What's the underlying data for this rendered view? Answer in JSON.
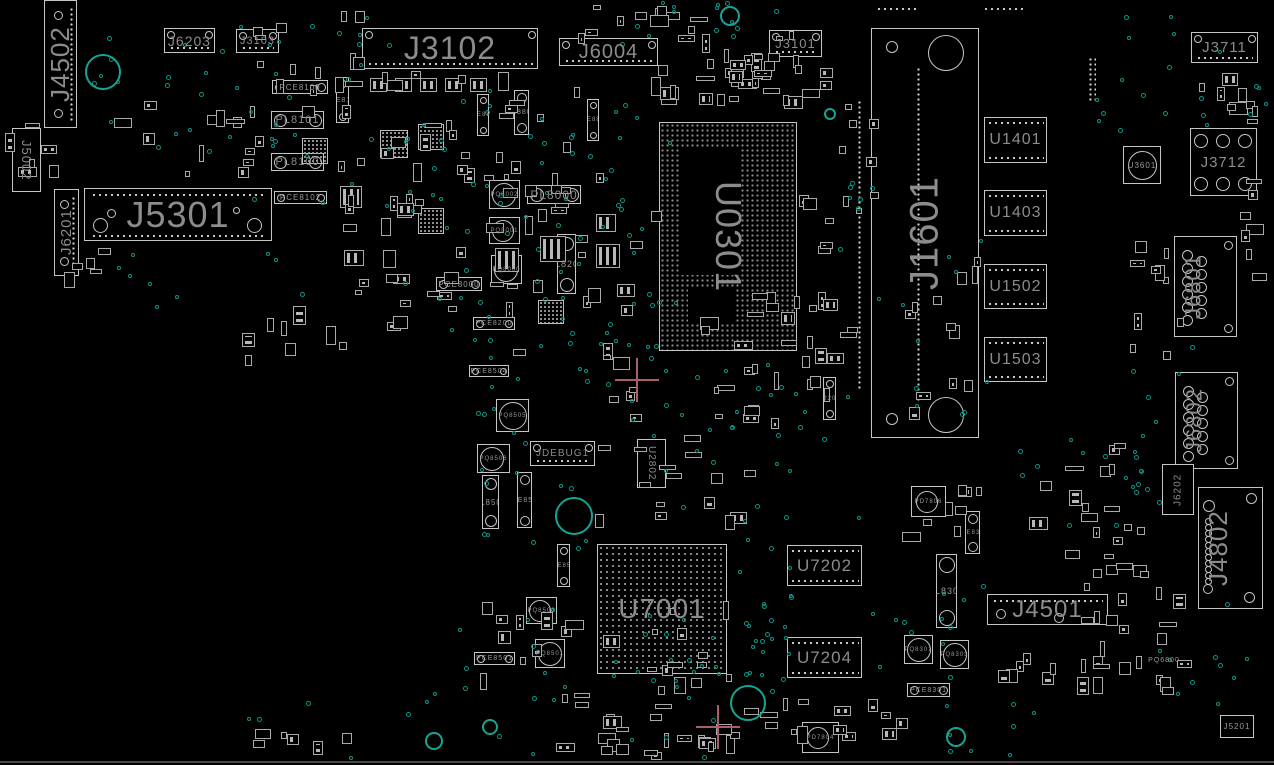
{
  "board": {
    "width": 1274,
    "height": 765,
    "colors": {
      "background": "#000000",
      "outline": "#c6c6c6",
      "label": "#8c8c8c",
      "via_teal": "#0e9488",
      "ring_teal": "#14a594",
      "fiducial_pink": "#a8606e"
    },
    "components": [
      {
        "r": "J4502",
        "k": "edgev",
        "x": 44,
        "y": 0,
        "w": 33,
        "h": 128,
        "f": 26,
        "o": "v",
        "d": "u"
      },
      {
        "r": "J5002",
        "k": "box",
        "x": 12,
        "y": 128,
        "w": 29,
        "h": 64,
        "f": 13,
        "o": "v",
        "d": "d"
      },
      {
        "r": "J6201",
        "k": "edgev",
        "x": 54,
        "y": 189,
        "w": 25,
        "h": 87,
        "f": 15,
        "o": "v",
        "d": "u"
      },
      {
        "r": "J5301",
        "k": "bigconn",
        "x": 84,
        "y": 188,
        "w": 188,
        "h": 53,
        "f": 36,
        "o": "h"
      },
      {
        "r": "J6203",
        "k": "box",
        "x": 164,
        "y": 28,
        "w": 51,
        "h": 25,
        "f": 14,
        "o": "h",
        "dots": "b",
        "corners": [
          "tl",
          "tr"
        ]
      },
      {
        "r": "J3103",
        "k": "box",
        "x": 236,
        "y": 29,
        "w": 43,
        "h": 24,
        "f": 11,
        "o": "h",
        "dots": "b",
        "corners": [
          "tl",
          "tr"
        ]
      },
      {
        "r": "J3102",
        "k": "box",
        "x": 362,
        "y": 28,
        "w": 176,
        "h": 41,
        "f": 32,
        "o": "h",
        "dots": "b",
        "corners": [
          "tl",
          "tr"
        ]
      },
      {
        "r": "J6004",
        "k": "box",
        "x": 559,
        "y": 38,
        "w": 99,
        "h": 28,
        "f": 20,
        "o": "h",
        "dots": "b",
        "corners": [
          "tl",
          "tr"
        ]
      },
      {
        "r": "J3101",
        "k": "box",
        "x": 769,
        "y": 30,
        "w": 53,
        "h": 27,
        "f": 13,
        "o": "h",
        "dots": "b",
        "corners": [
          "tl",
          "tr"
        ]
      },
      {
        "r": "J3711",
        "k": "box",
        "x": 1191,
        "y": 32,
        "w": 67,
        "h": 31,
        "f": 15,
        "o": "h",
        "dots": "b",
        "corners": [
          "tl",
          "tr"
        ]
      },
      {
        "r": "U0301",
        "k": "bga",
        "x": 659,
        "y": 122,
        "w": 138,
        "h": 229,
        "f": 36,
        "o": "v",
        "d": "d",
        "pitch": 5,
        "voids": [
          [
            21,
            24,
            58,
            128
          ],
          [
            28,
            166,
            48,
            34
          ]
        ]
      },
      {
        "r": "J1601",
        "k": "slot",
        "x": 871,
        "y": 28,
        "w": 108,
        "h": 410,
        "f": 40,
        "o": "v",
        "d": "u"
      },
      {
        "r": "U1401",
        "k": "mem",
        "x": 984,
        "y": 117,
        "w": 63,
        "h": 46,
        "f": 16,
        "o": "h"
      },
      {
        "r": "U1403",
        "k": "mem",
        "x": 984,
        "y": 190,
        "w": 63,
        "h": 46,
        "f": 16,
        "o": "h"
      },
      {
        "r": "U1502",
        "k": "mem",
        "x": 984,
        "y": 264,
        "w": 63,
        "h": 45,
        "f": 16,
        "o": "h"
      },
      {
        "r": "U1503",
        "k": "mem",
        "x": 984,
        "y": 337,
        "w": 63,
        "h": 45,
        "f": 16,
        "o": "h"
      },
      {
        "r": "U3601",
        "k": "sqc",
        "x": 1123,
        "y": 146,
        "w": 38,
        "h": 38,
        "f": 8
      },
      {
        "r": "J3712",
        "k": "jack",
        "x": 1190,
        "y": 128,
        "w": 67,
        "h": 68,
        "f": 15,
        "o": "h"
      },
      {
        "r": "J6801",
        "k": "dsub",
        "x": 1174,
        "y": 236,
        "w": 63,
        "h": 101,
        "f": 22,
        "o": "v",
        "d": "u"
      },
      {
        "r": "J6802",
        "k": "dsub",
        "x": 1175,
        "y": 372,
        "w": 63,
        "h": 97,
        "f": 22,
        "o": "v",
        "d": "u"
      },
      {
        "r": "J6202",
        "k": "box",
        "x": 1162,
        "y": 464,
        "w": 32,
        "h": 51,
        "f": 10,
        "o": "v",
        "d": "u"
      },
      {
        "r": "J4802",
        "k": "dsubd",
        "x": 1198,
        "y": 487,
        "w": 65,
        "h": 122,
        "f": 26,
        "o": "v",
        "d": "u"
      },
      {
        "r": "JDEBUG1",
        "k": "box",
        "x": 530,
        "y": 441,
        "w": 65,
        "h": 25,
        "f": 10,
        "o": "h",
        "dots": "b",
        "corners": [
          "tl",
          "tr"
        ]
      },
      {
        "r": "U2802",
        "k": "box",
        "x": 637,
        "y": 439,
        "w": 29,
        "h": 49,
        "f": 10,
        "o": "v",
        "d": "d"
      },
      {
        "r": "U7001",
        "k": "bga",
        "x": 597,
        "y": 544,
        "w": 130,
        "h": 130,
        "f": 28,
        "o": "h",
        "pitch": 6
      },
      {
        "r": "U7202",
        "k": "mem",
        "x": 787,
        "y": 545,
        "w": 75,
        "h": 41,
        "f": 17,
        "o": "h"
      },
      {
        "r": "U7204",
        "k": "mem",
        "x": 787,
        "y": 637,
        "w": 75,
        "h": 41,
        "f": 17,
        "o": "h"
      },
      {
        "r": "PL8301",
        "k": "pillv",
        "x": 936,
        "y": 554,
        "w": 21,
        "h": 74,
        "f": 9,
        "d": "d"
      },
      {
        "r": "J4501",
        "k": "box",
        "x": 987,
        "y": 594,
        "w": 121,
        "h": 31,
        "f": 24,
        "o": "h",
        "dots": "t",
        "inner_circles": [
          [
            8,
            14,
            10
          ],
          [
            66,
            18,
            10
          ]
        ]
      },
      {
        "r": "J5201",
        "k": "box",
        "x": 1220,
        "y": 715,
        "w": 34,
        "h": 23,
        "f": 8,
        "o": "h"
      },
      {
        "r": "PCE8100",
        "k": "pill",
        "x": 272,
        "y": 80,
        "w": 56,
        "h": 14,
        "f": 8
      },
      {
        "r": "PL8101",
        "k": "pill",
        "x": 271,
        "y": 111,
        "w": 53,
        "h": 18,
        "f": 11
      },
      {
        "r": "PL8100",
        "k": "pill",
        "x": 271,
        "y": 153,
        "w": 53,
        "h": 18,
        "f": 11
      },
      {
        "r": "PCE8102",
        "k": "pill",
        "x": 274,
        "y": 191,
        "w": 53,
        "h": 13,
        "f": 8
      },
      {
        "r": "PCE8101",
        "k": "pillv",
        "x": 336,
        "y": 77,
        "w": 13,
        "h": 46,
        "f": 7,
        "d": "u"
      },
      {
        "r": "PCE8801",
        "k": "pillv",
        "x": 477,
        "y": 94,
        "w": 12,
        "h": 42,
        "f": 6,
        "d": "u"
      },
      {
        "r": "PL8801",
        "k": "pillv",
        "x": 514,
        "y": 90,
        "w": 15,
        "h": 45,
        "f": 7,
        "d": "u"
      },
      {
        "r": "PCE8802",
        "k": "pillv",
        "x": 587,
        "y": 99,
        "w": 12,
        "h": 42,
        "f": 6,
        "d": "u"
      },
      {
        "r": "PL8000",
        "k": "pill",
        "x": 527,
        "y": 185,
        "w": 54,
        "h": 19,
        "f": 12
      },
      {
        "r": "PQ8002",
        "k": "ind",
        "x": 489,
        "y": 180,
        "w": 31,
        "h": 29,
        "f": 6
      },
      {
        "r": "PQ8001",
        "k": "ind",
        "x": 489,
        "y": 217,
        "w": 31,
        "h": 27,
        "f": 6
      },
      {
        "r": "PQ8000",
        "k": "ind",
        "x": 491,
        "y": 255,
        "w": 31,
        "h": 29,
        "f": 6
      },
      {
        "r": "PL8200",
        "k": "pillv",
        "x": 557,
        "y": 234,
        "w": 19,
        "h": 60,
        "f": 9,
        "d": "d"
      },
      {
        "r": "PCE8000",
        "k": "pill",
        "x": 436,
        "y": 277,
        "w": 46,
        "h": 14,
        "f": 8
      },
      {
        "r": "PCE8200",
        "k": "pill",
        "x": 473,
        "y": 317,
        "w": 42,
        "h": 13,
        "f": 7
      },
      {
        "r": "PCE8504",
        "k": "pill",
        "x": 469,
        "y": 365,
        "w": 40,
        "h": 12,
        "f": 7
      },
      {
        "r": "PQ8505",
        "k": "ind",
        "x": 496,
        "y": 399,
        "w": 33,
        "h": 33,
        "f": 6
      },
      {
        "r": "PQ8506",
        "k": "ind",
        "x": 477,
        "y": 444,
        "w": 33,
        "h": 29,
        "f": 6
      },
      {
        "r": "PL8502",
        "k": "pillv",
        "x": 482,
        "y": 475,
        "w": 17,
        "h": 54,
        "f": 8,
        "d": "d"
      },
      {
        "r": "PCE8502",
        "k": "pillv",
        "x": 517,
        "y": 472,
        "w": 15,
        "h": 56,
        "f": 7,
        "d": "d"
      },
      {
        "r": "PCE8506",
        "k": "pillv",
        "x": 557,
        "y": 544,
        "w": 13,
        "h": 43,
        "f": 6,
        "d": "d"
      },
      {
        "r": "PQ8503",
        "k": "ind",
        "x": 526,
        "y": 597,
        "w": 31,
        "h": 27,
        "f": 6
      },
      {
        "r": "PQ8501",
        "k": "ind",
        "x": 535,
        "y": 639,
        "w": 30,
        "h": 29,
        "f": 6
      },
      {
        "r": "PCE8501",
        "k": "pill",
        "x": 474,
        "y": 652,
        "w": 41,
        "h": 13,
        "f": 7
      },
      {
        "r": "PD7806",
        "k": "sqc",
        "x": 911,
        "y": 486,
        "w": 35,
        "h": 31,
        "f": 6
      },
      {
        "r": "PCE8304",
        "k": "pillv",
        "x": 965,
        "y": 511,
        "w": 15,
        "h": 43,
        "f": 6,
        "d": "d"
      },
      {
        "r": "PQ8301",
        "k": "ind",
        "x": 904,
        "y": 635,
        "w": 29,
        "h": 29,
        "f": 6
      },
      {
        "r": "PQ8303",
        "k": "ind",
        "x": 940,
        "y": 640,
        "w": 29,
        "h": 29,
        "f": 6
      },
      {
        "r": "PCE8301",
        "k": "pill",
        "x": 907,
        "y": 683,
        "w": 43,
        "h": 14,
        "f": 7
      },
      {
        "r": "PD7804",
        "k": "sqc",
        "x": 802,
        "y": 722,
        "w": 37,
        "h": 31,
        "f": 6
      },
      {
        "r": "X2201",
        "k": "pillv",
        "x": 823,
        "y": 377,
        "w": 13,
        "h": 43,
        "f": 6,
        "d": "d"
      },
      {
        "r": "PQ6800",
        "k": "label",
        "x": 1146,
        "y": 655,
        "w": 36,
        "h": 11,
        "f": 7
      }
    ],
    "padrows": [
      {
        "x": 876,
        "y": 6,
        "w": 42,
        "h": 8,
        "o": "h"
      },
      {
        "x": 983,
        "y": 6,
        "w": 40,
        "h": 8,
        "o": "h"
      },
      {
        "x": 1088,
        "y": 57,
        "w": 8,
        "h": 44,
        "o": "v"
      },
      {
        "x": 857,
        "y": 100,
        "w": 5,
        "h": 290,
        "o": "v"
      }
    ],
    "explicit_parts": [
      [
        370,
        78,
        17,
        14
      ],
      [
        395,
        78,
        17,
        14
      ],
      [
        420,
        78,
        17,
        14
      ],
      [
        445,
        78,
        17,
        14
      ],
      [
        470,
        78,
        17,
        14
      ],
      [
        418,
        124,
        26,
        26,
        "q"
      ],
      [
        418,
        208,
        26,
        26,
        "q"
      ],
      [
        538,
        300,
        26,
        24,
        "q"
      ],
      [
        302,
        138,
        26,
        26,
        "q"
      ],
      [
        380,
        130,
        28,
        28,
        "q"
      ],
      [
        340,
        186,
        22,
        22
      ],
      [
        596,
        244,
        24,
        24
      ],
      [
        596,
        214,
        20,
        18
      ],
      [
        344,
        250,
        20,
        16
      ],
      [
        495,
        248,
        24,
        24
      ],
      [
        540,
        236,
        26,
        26
      ]
    ],
    "part_fields": [
      [
        250,
        8,
        120,
        120,
        16
      ],
      [
        86,
        100,
        190,
        85,
        14
      ],
      [
        380,
        70,
        290,
        160,
        34
      ],
      [
        330,
        150,
        150,
        190,
        24
      ],
      [
        483,
        200,
        180,
        175,
        20
      ],
      [
        560,
        0,
        150,
        45,
        12
      ],
      [
        648,
        52,
        190,
        58,
        22
      ],
      [
        595,
        385,
        185,
        145,
        26
      ],
      [
        680,
        290,
        140,
        110,
        14
      ],
      [
        792,
        195,
        85,
        225,
        16
      ],
      [
        898,
        245,
        85,
        185,
        12
      ],
      [
        1000,
        440,
        150,
        145,
        18
      ],
      [
        1078,
        550,
        115,
        155,
        22
      ],
      [
        470,
        600,
        270,
        155,
        36
      ],
      [
        760,
        685,
        150,
        70,
        12
      ],
      [
        888,
        478,
        95,
        65,
        8
      ],
      [
        1128,
        198,
        65,
        175,
        10
      ],
      [
        1196,
        66,
        70,
        55,
        8
      ],
      [
        4,
        120,
        55,
        110,
        6
      ],
      [
        222,
        728,
        170,
        30,
        6
      ],
      [
        836,
        95,
        50,
        120,
        8
      ],
      [
        1240,
        60,
        30,
        250,
        8
      ],
      [
        60,
        240,
        60,
        60,
        5
      ],
      [
        600,
        690,
        180,
        70,
        14
      ],
      [
        990,
        630,
        120,
        70,
        10
      ],
      [
        700,
        30,
        100,
        60,
        14
      ],
      [
        230,
        290,
        120,
        80,
        8
      ]
    ],
    "via_fields": [
      [
        88,
        20,
        200,
        140,
        26
      ],
      [
        250,
        120,
        210,
        180,
        24
      ],
      [
        420,
        80,
        250,
        200,
        36
      ],
      [
        440,
        280,
        230,
        140,
        26
      ],
      [
        560,
        300,
        130,
        100,
        12
      ],
      [
        620,
        0,
        190,
        60,
        14
      ],
      [
        650,
        360,
        210,
        160,
        28
      ],
      [
        735,
        518,
        55,
        175,
        26
      ],
      [
        860,
        560,
        130,
        120,
        12
      ],
      [
        430,
        608,
        310,
        150,
        36
      ],
      [
        480,
        430,
        130,
        120,
        12
      ],
      [
        900,
        230,
        85,
        190,
        10
      ],
      [
        1090,
        8,
        130,
        120,
        14
      ],
      [
        1130,
        330,
        95,
        200,
        12
      ],
      [
        1000,
        430,
        150,
        130,
        12
      ],
      [
        940,
        700,
        130,
        60,
        8
      ],
      [
        1140,
        600,
        125,
        120,
        10
      ],
      [
        200,
        690,
        260,
        70,
        6
      ],
      [
        820,
        180,
        60,
        130,
        8
      ],
      [
        1196,
        64,
        70,
        60,
        6
      ],
      [
        300,
        10,
        90,
        70,
        8
      ],
      [
        90,
        240,
        100,
        80,
        6
      ],
      [
        566,
        100,
        60,
        110,
        8
      ]
    ],
    "rings": [
      [
        103,
        72,
        18
      ],
      [
        730,
        16,
        10
      ],
      [
        830,
        114,
        6
      ],
      [
        574,
        516,
        19
      ],
      [
        748,
        703,
        18
      ],
      [
        956,
        737,
        10
      ],
      [
        434,
        741,
        9
      ],
      [
        490,
        727,
        8
      ]
    ],
    "fiducial_crosses": [
      [
        637,
        380
      ],
      [
        718,
        727
      ]
    ],
    "edge_lines": [
      [
        0,
        761,
        1274,
        2
      ]
    ]
  }
}
